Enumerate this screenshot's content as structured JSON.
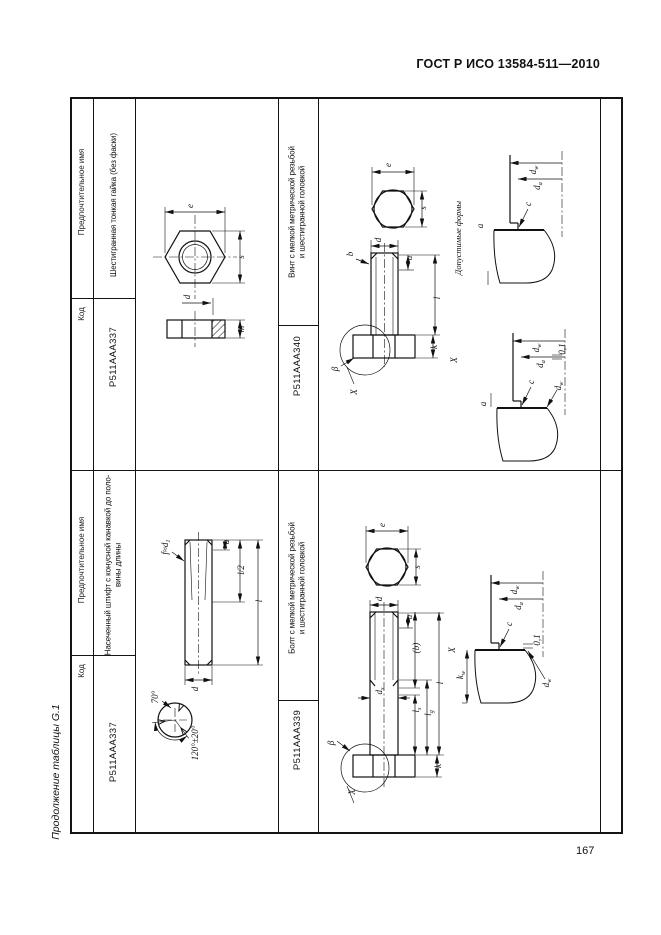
{
  "page": {
    "standard_ref": "ГОСТ Р ИСО 13584-511—2010",
    "continuation_note": "Продолжение таблицы G.1",
    "page_number": "167"
  },
  "table": {
    "col_headers": {
      "code": "Код",
      "name": "Предпочтительное имя"
    },
    "items": [
      {
        "code": "P511AAA337",
        "name": "Шестигранная тонкая гайка (без фаски)"
      },
      {
        "code": "P511AAA340",
        "name": "Винт с мелкой метрической резьбой\nи шестигранной головкой"
      },
      {
        "code": "P511AAA337",
        "name": "Насеченный штифт с конусной канавкой до поло-\nвины длины"
      },
      {
        "code": "P511AAA339",
        "name": "Болт с мелкой метрической резьбой\nи шестигранной головкой"
      }
    ]
  },
  "figures": {
    "nut": {
      "description": "hex-thin-nut two-view drawing",
      "labels": [
        [
          "e",
          58,
          111
        ],
        [
          "s",
          109,
          162
        ],
        [
          "m",
          109,
          234
        ],
        [
          "d",
          55,
          202
        ]
      ]
    },
    "screw": {
      "description": "hex-head screw with fine metric thread, detail views of permissible head forms",
      "caption": "Допустимые формы",
      "labels": [
        [
          "e",
          73,
          70
        ],
        [
          "s",
          108,
          113
        ],
        [
          "d",
          63,
          145
        ],
        [
          "u",
          94,
          163
        ],
        [
          "b",
          35,
          159
        ],
        [
          "l",
          122,
          203
        ],
        [
          "k",
          119,
          252
        ],
        [
          "β",
          20,
          274
        ],
        [
          "X",
          39,
          297
        ],
        [
          "X",
          139,
          265
        ],
        [
          "Допустимые формы",
          143,
          143,
          8.5
        ],
        [
          "d_w",
          218,
          75
        ],
        [
          "d_a",
          222,
          91
        ],
        [
          "c",
          213,
          109
        ],
        [
          "a",
          165,
          131
        ],
        [
          "d_w",
          221,
          253
        ],
        [
          "d_a",
          225,
          269
        ],
        [
          "c",
          216,
          287
        ],
        [
          "a",
          168,
          309
        ],
        [
          "0,1",
          247,
          254
        ],
        [
          "d_w",
          243,
          291
        ]
      ]
    },
    "pin": {
      "description": "grooved pin with conical grooves over half length, groove section detail",
      "labels": [
        [
          "f≈d_1",
          33,
          77
        ],
        [
          "a",
          94,
          72
        ],
        [
          "l/2",
          109,
          100
        ],
        [
          "l",
          127,
          131
        ],
        [
          "d",
          63,
          219
        ],
        [
          "70°",
          23,
          227
        ],
        [
          "120°±20°",
          63,
          273
        ]
      ]
    },
    "bolt": {
      "description": "hex-head bolt with fine metric thread, detail view of permissible head form",
      "labels": [
        [
          "e",
          67,
          55
        ],
        [
          "s",
          102,
          97
        ],
        [
          "d",
          64,
          129
        ],
        [
          "u",
          94,
          147
        ],
        [
          "(b)",
          101,
          178
        ],
        [
          "l_s",
          101,
          240
        ],
        [
          "l_g",
          113,
          243
        ],
        [
          "l",
          125,
          213
        ],
        [
          "k",
          123,
          296
        ],
        [
          "d_s",
          64,
          221
        ],
        [
          "β",
          16,
          273
        ],
        [
          "X",
          37,
          322
        ],
        [
          "X",
          137,
          180
        ],
        [
          "d_w",
          199,
          120
        ],
        [
          "d_a",
          203,
          136
        ],
        [
          "c",
          194,
          154
        ],
        [
          "k_w",
          145,
          205
        ],
        [
          "0,1",
          222,
          170
        ],
        [
          "d_w",
          231,
          213
        ]
      ]
    }
  }
}
